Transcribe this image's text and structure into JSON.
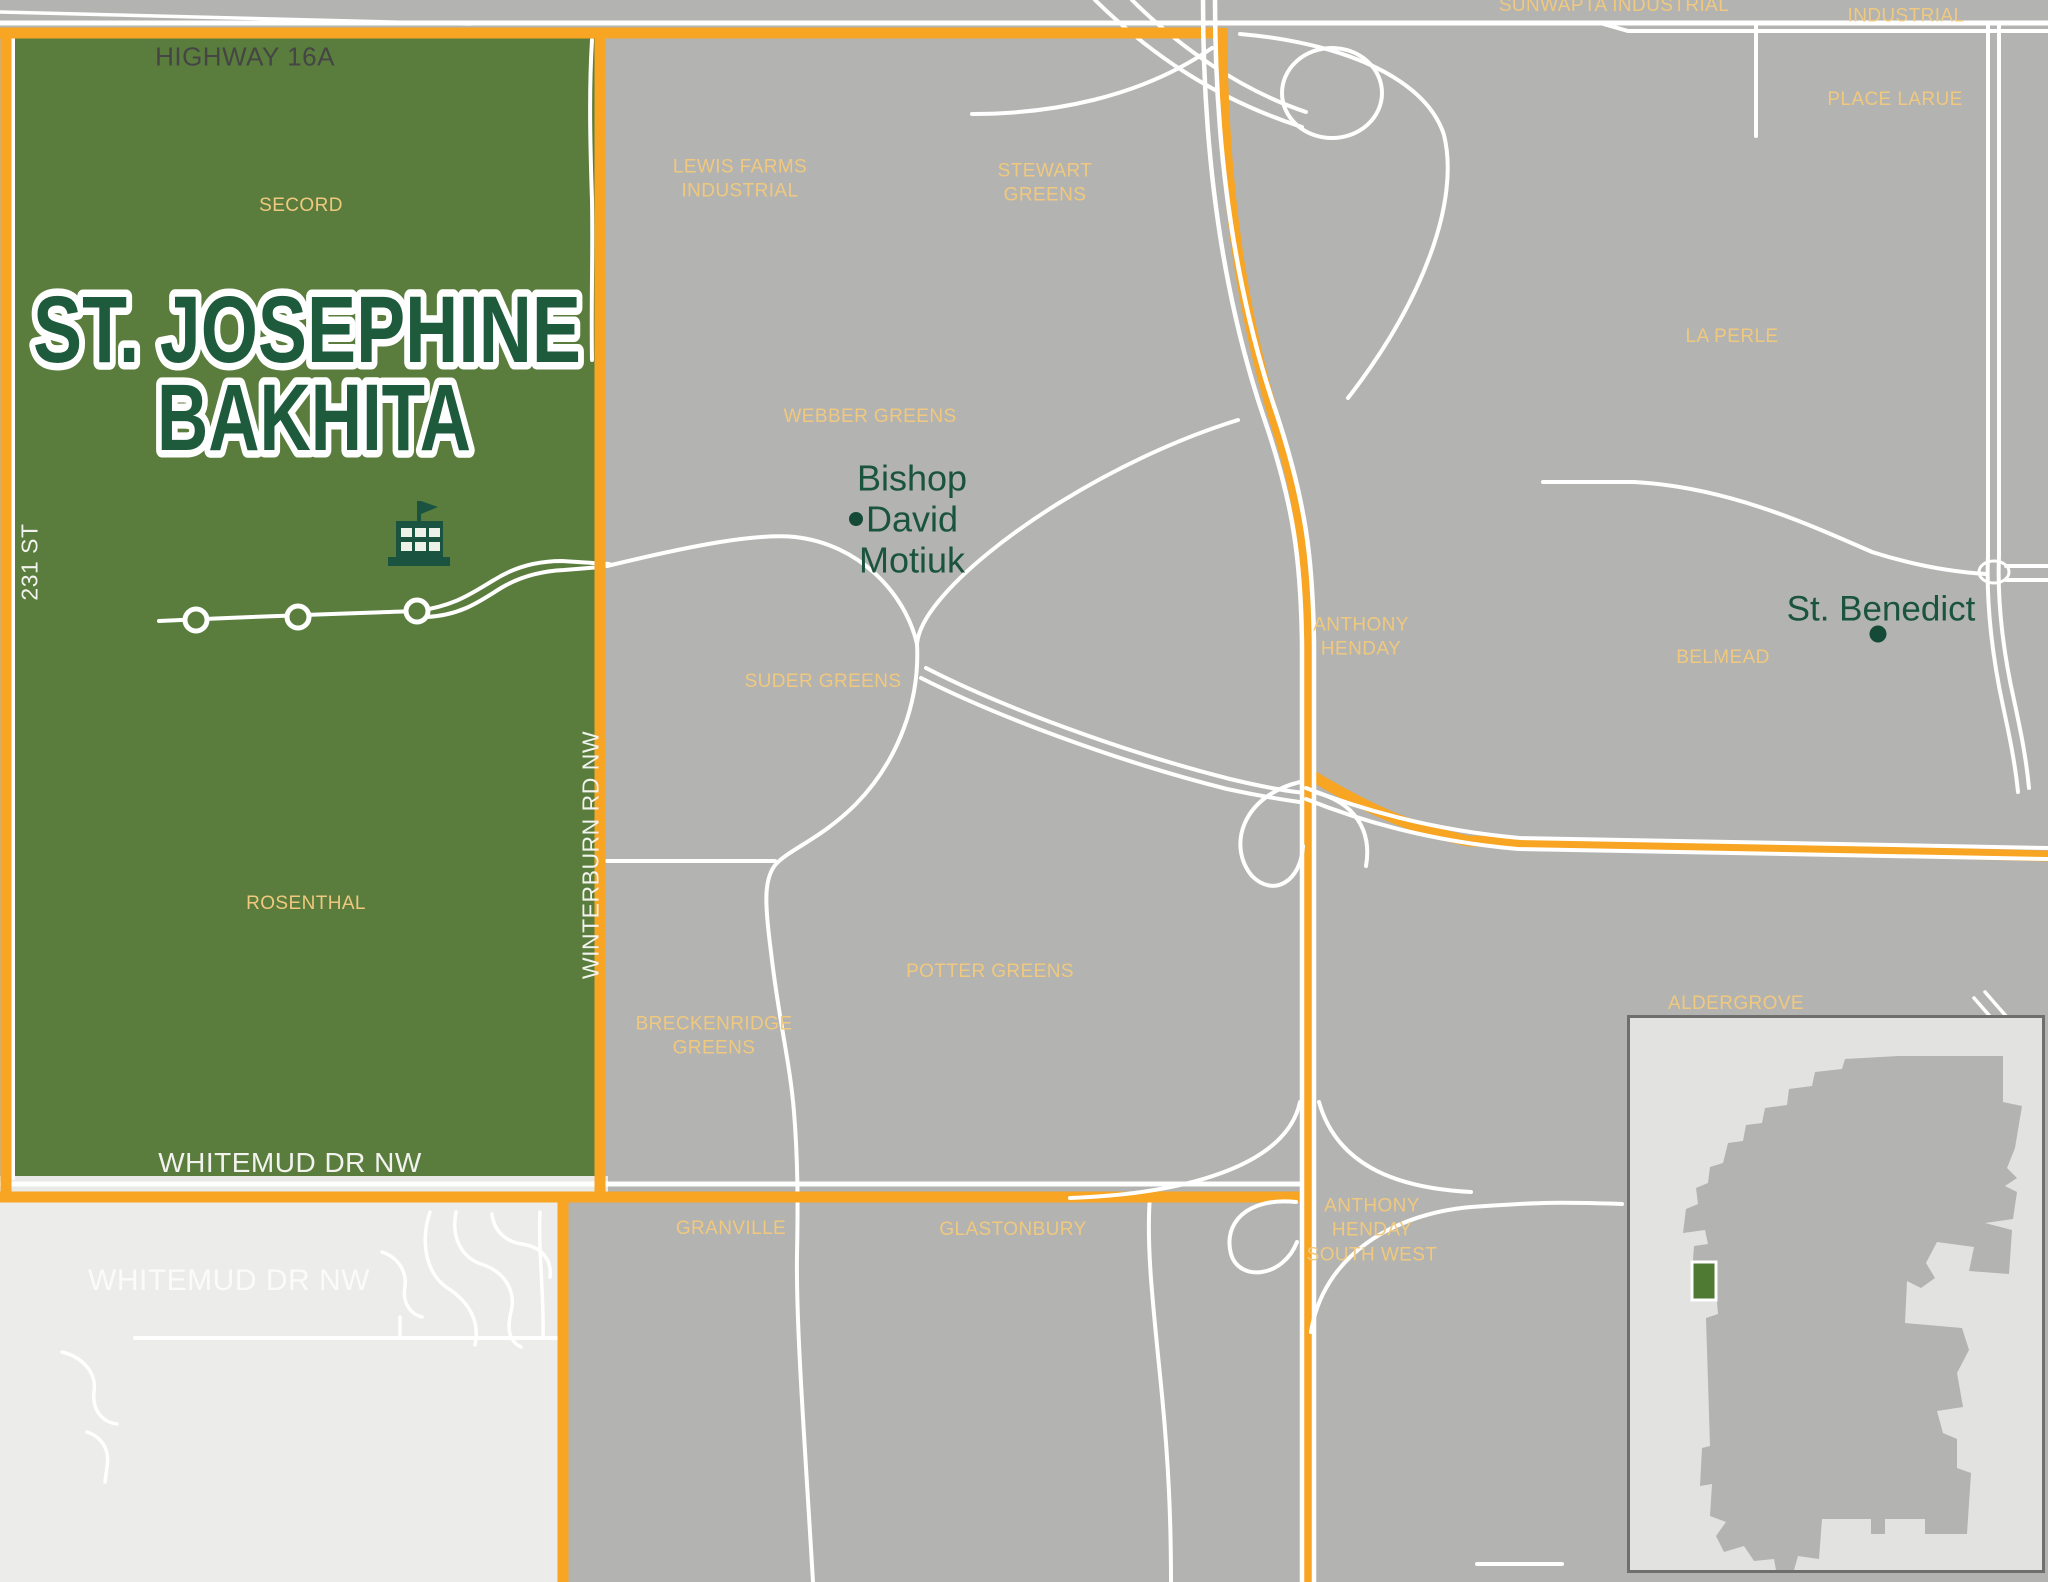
{
  "title": {
    "line1": "ST. JOSEPHINE",
    "line2": "BAKHITA"
  },
  "roads": {
    "highway_16a": "HIGHWAY 16A",
    "street_231": "231 ST",
    "winterburn_rd": "WINTERBURN RD NW",
    "whitemud_upper": "WHITEMUD DR NW",
    "whitemud_lower": "WHITEMUD DR NW"
  },
  "neighborhoods": [
    {
      "id": "secord",
      "label": "SECORD"
    },
    {
      "id": "lewis-farms-industrial",
      "label": "LEWIS FARMS\nINDUSTRIAL"
    },
    {
      "id": "stewart-greens",
      "label": "STEWART\nGREENS"
    },
    {
      "id": "webber-greens",
      "label": "WEBBER GREENS"
    },
    {
      "id": "suder-greens",
      "label": "SUDER GREENS"
    },
    {
      "id": "rosenthal",
      "label": "ROSENTHAL"
    },
    {
      "id": "potter-greens",
      "label": "POTTER GREENS"
    },
    {
      "id": "breckenridge-greens",
      "label": "BRECKENRIDGE\nGREENS"
    },
    {
      "id": "granville",
      "label": "GRANVILLE"
    },
    {
      "id": "glastonbury",
      "label": "GLASTONBURY"
    },
    {
      "id": "anthony-henday",
      "label": "ANTHONY\nHENDAY"
    },
    {
      "id": "anthony-henday-south-west",
      "label": "ANTHONY\nHENDAY\nSOUTH WEST"
    },
    {
      "id": "belmead",
      "label": "BELMEAD"
    },
    {
      "id": "la-perle",
      "label": "LA PERLE"
    },
    {
      "id": "place-larue",
      "label": "PLACE LARUE"
    },
    {
      "id": "sunwapta-industrial",
      "label": "SUNWAPTA INDUSTRIAL"
    },
    {
      "id": "morin-industrial",
      "label": "MORIN INDUSTRIAL"
    },
    {
      "id": "aldergrove",
      "label": "ALDERGROVE"
    }
  ],
  "schools": [
    {
      "id": "bishop-david-motiuk",
      "label": "Bishop\nDavid\nMotiuk"
    },
    {
      "id": "st-benedict",
      "label": "St. Benedict"
    }
  ],
  "colors": {
    "boundary_orange": "#f7a522",
    "region_green": "#5a7d3d",
    "neighborhood_label": "#f0c97e",
    "school_text": "#1a5340",
    "map_gray": "#b3b3b1",
    "outside_city_gray": "#ececea",
    "road_white": "#ffffff"
  }
}
